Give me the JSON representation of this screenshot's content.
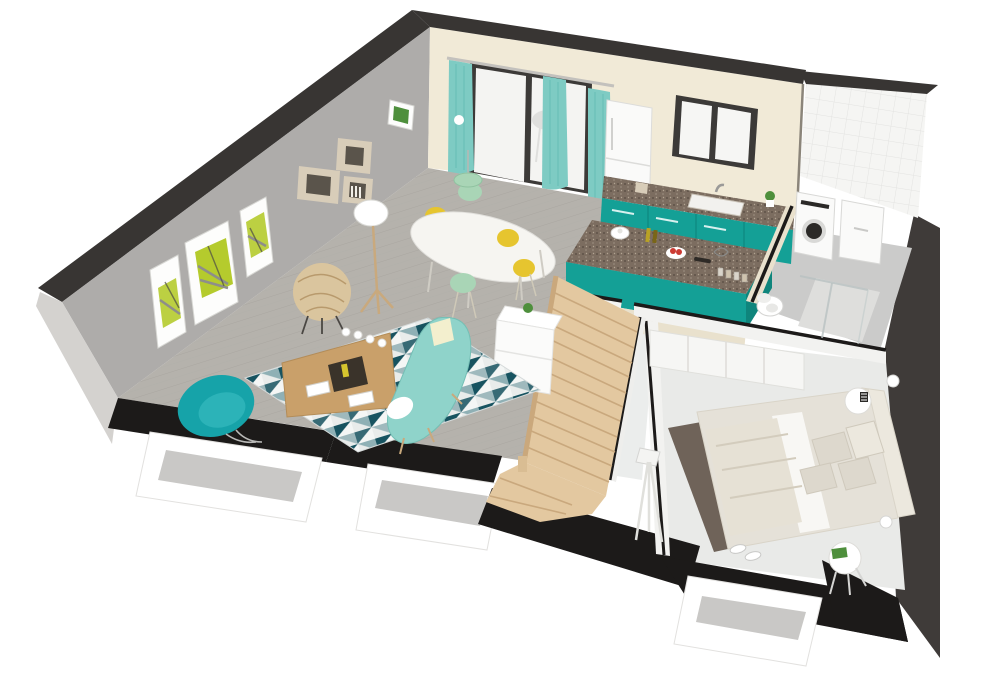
{
  "scene": {
    "type": "3d-floorplan-render",
    "view": "isometric-cutaway",
    "floors_shown": 1
  },
  "palette": {
    "background": "#ffffff",
    "wall_cap_dark": "#383533",
    "left_wall": "#aeacaa",
    "left_wall_exterior": "#d4d2cf",
    "back_wall": "#f1ead7",
    "tile_wall": "#f5f5f3",
    "tile_grout": "#e3e3e1",
    "right_wall": "#3f3b39",
    "slab_black": "#1c1a19",
    "foundation": "#ffffff",
    "foundation_shadow": "#c9c8c6",
    "wood_floor": "#b5b2ac",
    "plank_line": "#a09c96",
    "bath_floor": "#cbcbca",
    "shower_tray": "#dededc",
    "hall_floor": "#ebedec",
    "bedroom_floor": "#e9eae8",
    "bedroom_rug": "#6f6359",
    "stair_wood": "#e3c8a0",
    "stair_edge": "#c9a87d",
    "teal_primary": "#14a096",
    "teal_dark": "#0f857c",
    "armchair_teal": "#16a3a9",
    "sofa_mint": "#8fd3ca",
    "curtain": "#7ecbc3",
    "chair_yellow": "#e6c52f",
    "chair_mint": "#a9d5b6",
    "dining_table": "#f6f5f1",
    "coffee_table": "#c9a06a",
    "table_tray": "#3a332a",
    "rug_dark": "#175360",
    "rug_mid": "#8fb0b5",
    "rug_light": "#e9eceb",
    "granite": "#7c6d60",
    "appliance_white": "#fafaf9",
    "washer_dark": "#2b2927",
    "frame_white": "#fdfdfc",
    "art_green": "#b5cb2d",
    "art_gray": "#8e8e8a",
    "shelf_beige": "#d8cdb9",
    "shelf_inner": "#5a544b",
    "bed_frame": "#e5e1d8",
    "bed_sheet": "#f8f7f4",
    "blanket": "#e6e1d5",
    "pillow": "#ddd8cd",
    "headboard": "#ece8de",
    "lamp_wood": "#c9a97d",
    "metal_gray": "#9b9a98",
    "plant_green": "#4e8f3c",
    "accent_red": "#cc3b33",
    "glass_frame": "#3c3a38",
    "glass_white": "#f4f4f2",
    "divider_cream": "#e9e1cd"
  },
  "rooms": {
    "living_room": [
      "triptych-wall-art",
      "cube-shelves",
      "rattan-chair",
      "floor-lamp",
      "geometric-rug",
      "coffee-table",
      "teal-armchair",
      "mint-sofa"
    ],
    "dining_area": [
      "oval-table",
      "yellow-chairs",
      "mint-chairs",
      "pendant-lamp"
    ],
    "kitchen": [
      "fridge",
      "teal-cabinets",
      "granite-counter",
      "sink",
      "window",
      "island",
      "fruit-bowl",
      "oil-bottles",
      "spice-jars"
    ],
    "bathroom": [
      "tiled-wall",
      "washing-machine",
      "dryer",
      "toilet",
      "shower"
    ],
    "bedroom": [
      "wardrobe",
      "double-bed",
      "pillows",
      "nightstands",
      "wall-sconces",
      "floor-lamp",
      "dark-rug",
      "sneakers"
    ],
    "circulation": [
      "wood-staircase",
      "railing",
      "sideboard",
      "hallway"
    ]
  }
}
